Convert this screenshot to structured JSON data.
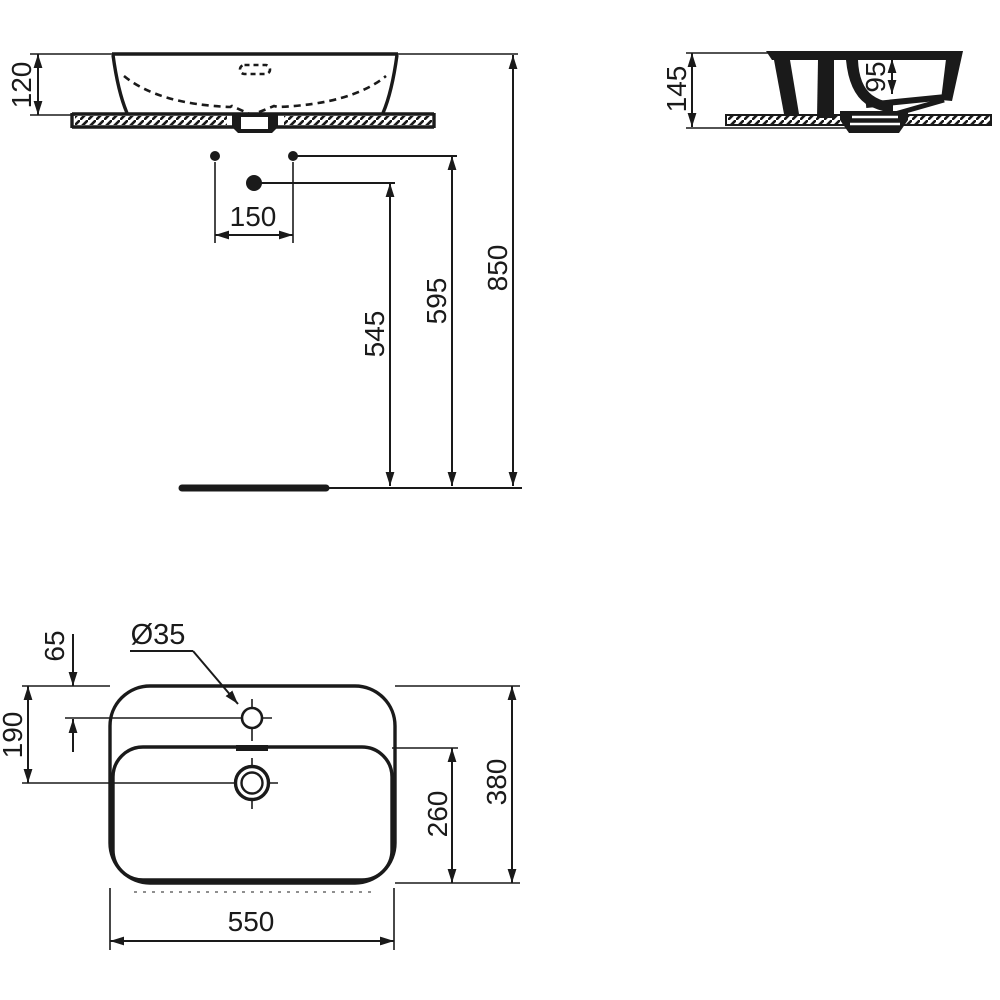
{
  "meta": {
    "drawing_type": "washbasin installation technical drawing",
    "ink_color": "#1a1a1a",
    "background_color": "#ffffff",
    "units": "mm"
  },
  "views": {
    "front": {
      "name": "front elevation with installation heights",
      "dims": {
        "basin_height_above_counter": "120",
        "fixing_hole_spacing": "150",
        "drain_outlet_height": "545",
        "fixing_holes_height": "595",
        "rim_height": "850"
      }
    },
    "side": {
      "name": "side section on countertop",
      "dims": {
        "overall_height": "145",
        "bowl_inner_depth": "95"
      }
    },
    "plan": {
      "name": "plan view",
      "dims": {
        "tap_hole_diameter": "Ø35",
        "tap_hole_offset_from_rear": "65",
        "drain_center_offset_from_rear": "190",
        "bowl_front_to_drain_extent": "260",
        "overall_depth": "380",
        "overall_width": "550"
      }
    }
  }
}
